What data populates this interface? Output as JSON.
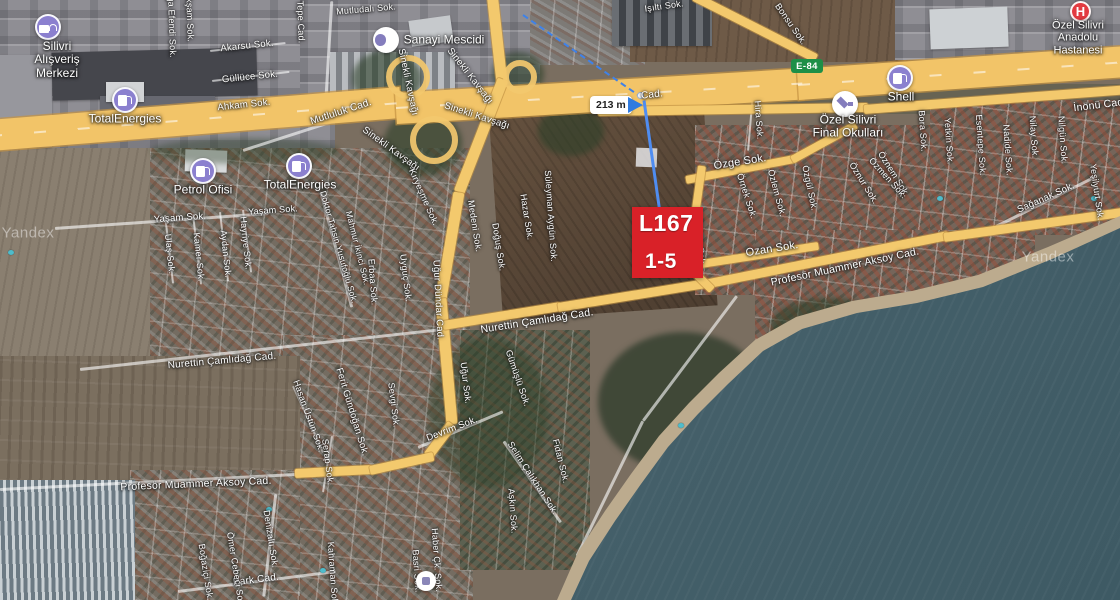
{
  "map": {
    "provider_watermark": "Yandex",
    "road_badge": "E-84",
    "measurement": {
      "distance_label": "213 m"
    },
    "parcel_label": {
      "line1": "L167",
      "line2": "1-5"
    },
    "colors": {
      "parcel_red": "#d92128",
      "measure_blue": "#3f82e8",
      "road_yellow": "#f3c96d",
      "poi_purple": "#8b80cf",
      "badge_green": "#1d8f47",
      "sea_teal": "#44606a"
    }
  },
  "watermarks": [
    {
      "text": "Yandex",
      "x": 28,
      "y": 233
    },
    {
      "text": "Yandex",
      "x": 1048,
      "y": 257
    }
  ],
  "pois": [
    {
      "id": "silivri-alisveris-merkezi",
      "icon": "bag",
      "x": 48,
      "y": 27,
      "lines": [
        "Silivri",
        "Alışveriş",
        "Merkezi"
      ],
      "lx": 57,
      "ly": 60
    },
    {
      "id": "totalenergies-north",
      "icon": "fuel",
      "x": 125,
      "y": 100,
      "lines": [
        "TotalEnergies"
      ],
      "lx": 125,
      "ly": 119
    },
    {
      "id": "totalenergies-south",
      "icon": "fuel",
      "x": 299,
      "y": 166,
      "lines": [
        "TotalEnergies"
      ],
      "lx": 300,
      "ly": 185
    },
    {
      "id": "petrol-ofisi",
      "icon": "fuel",
      "x": 203,
      "y": 171,
      "lines": [
        "Petrol Ofisi"
      ],
      "lx": 203,
      "ly": 190
    },
    {
      "id": "sanayi-mescidi",
      "icon": "mosque",
      "x": 386,
      "y": 40,
      "lines": [
        "Sanayi Mescidi"
      ],
      "lx": 444,
      "ly": 40
    },
    {
      "id": "shell",
      "icon": "fuel",
      "x": 900,
      "y": 78,
      "lines": [
        "Shell"
      ],
      "lx": 901,
      "ly": 97
    },
    {
      "id": "ozel-silivri-final-okullari",
      "icon": "school",
      "x": 845,
      "y": 104,
      "lines": [
        "Özel Silivri",
        "Final Okulları"
      ],
      "lx": 848,
      "ly": 127
    },
    {
      "id": "ozel-silivri-anadolu-hastanesi",
      "icon": "hospital",
      "x": 1080,
      "y": 11,
      "lines": [
        "Özel Silivri",
        "Anadolu",
        "Hastanesi"
      ],
      "lx": 1078,
      "ly": 38,
      "ls": 11
    },
    {
      "id": "poi-unlabeled",
      "icon": "generic",
      "x": 426,
      "y": 581,
      "lines": [],
      "lx": 426,
      "ly": 595
    }
  ],
  "street_labels": [
    {
      "t": "Akarsu Sok.",
      "x": 247,
      "y": 46,
      "r": -6
    },
    {
      "t": "Güllüce Sok.",
      "x": 250,
      "y": 77,
      "r": -6
    },
    {
      "t": "Ahkam Sok.",
      "x": 244,
      "y": 105,
      "r": -6
    },
    {
      "t": "Ağa Efendi Sok.",
      "x": 172,
      "y": 24,
      "r": 88,
      "s": 9
    },
    {
      "t": "Akşam Sok.",
      "x": 190,
      "y": 17,
      "r": 88,
      "s": 9
    },
    {
      "t": "Tepe Cad.",
      "x": 301,
      "y": 22,
      "r": 88,
      "s": 9
    },
    {
      "t": "Mutludalı Sok.",
      "x": 366,
      "y": 9,
      "r": -5,
      "s": 9
    },
    {
      "t": "Mutluluk Cad.",
      "x": 341,
      "y": 112,
      "r": -18,
      "s": 10
    },
    {
      "t": "Sinekli Kavşağı",
      "x": 408,
      "y": 82,
      "r": 78
    },
    {
      "t": "Sinekli Kavşağı",
      "x": 470,
      "y": 76,
      "r": 52
    },
    {
      "t": "Sinekli Kavşağı",
      "x": 477,
      "y": 116,
      "r": 18
    },
    {
      "t": "Sinekli Kavşağı",
      "x": 391,
      "y": 149,
      "r": 36
    },
    {
      "t": "Kıryeşme Sok.",
      "x": 424,
      "y": 197,
      "r": 66,
      "s": 9
    },
    {
      "t": "Süleyman Aygün Sok.",
      "x": 551,
      "y": 216,
      "r": 86,
      "s": 9
    },
    {
      "t": "Işıltı Sok.",
      "x": 664,
      "y": 6,
      "r": -8,
      "s": 9
    },
    {
      "t": "Bonsu Sok.",
      "x": 791,
      "y": 24,
      "r": 55,
      "s": 9
    },
    {
      "t": "Cad.",
      "x": 652,
      "y": 95,
      "r": -6,
      "s": 10
    },
    {
      "t": "Özge Sok.",
      "x": 740,
      "y": 162,
      "r": -9,
      "s": 11
    },
    {
      "t": "Hira Sok.",
      "x": 759,
      "y": 120,
      "r": 86,
      "s": 9
    },
    {
      "t": "Örnek Sok.",
      "x": 747,
      "y": 196,
      "r": 72,
      "s": 9
    },
    {
      "t": "Özlem Sok.",
      "x": 777,
      "y": 193,
      "r": 75,
      "s": 9
    },
    {
      "t": "Özgül Sok.",
      "x": 810,
      "y": 188,
      "r": 78,
      "s": 9
    },
    {
      "t": "Öznur Sok.",
      "x": 864,
      "y": 183,
      "r": 58,
      "s": 9
    },
    {
      "t": "Öznem Sok.",
      "x": 894,
      "y": 174,
      "r": 58,
      "s": 9
    },
    {
      "t": "Özmen Sok.",
      "x": 888,
      "y": 178,
      "r": 48,
      "s": 9
    },
    {
      "t": "Özcan Sok.",
      "x": 700,
      "y": 242,
      "r": 84,
      "s": 9
    },
    {
      "t": "Ozan Sok.",
      "x": 772,
      "y": 249,
      "r": -9,
      "s": 11
    },
    {
      "t": "Profesör Muammer Aksoy Cad.",
      "x": 845,
      "y": 267,
      "r": -12,
      "s": 10.5
    },
    {
      "t": "Profesör Muammer Aksoy Cad.",
      "x": 196,
      "y": 484,
      "r": -2.5,
      "s": 10.5
    },
    {
      "t": "Nurettin Çamlıdağ Cad.",
      "x": 537,
      "y": 321,
      "r": -9,
      "s": 10.5
    },
    {
      "t": "Nurettin Çamlıdağ Cad.",
      "x": 222,
      "y": 361,
      "r": -5,
      "s": 10
    },
    {
      "t": "Yaşam Sok.",
      "x": 180,
      "y": 218,
      "r": -4
    },
    {
      "t": "Yaşam Sok.",
      "x": 273,
      "y": 210,
      "r": -4,
      "s": 9
    },
    {
      "t": "Ulaş Sok.",
      "x": 170,
      "y": 254,
      "r": 84,
      "s": 9
    },
    {
      "t": "Kamer Sok.",
      "x": 199,
      "y": 257,
      "r": 84,
      "s": 9
    },
    {
      "t": "Aydan Sok.",
      "x": 226,
      "y": 254,
      "r": 84,
      "s": 9
    },
    {
      "t": "Hayriye Sok.",
      "x": 246,
      "y": 243,
      "r": 84,
      "s": 9
    },
    {
      "t": "Doktor Tahsin Yusufoğlu Sok.",
      "x": 339,
      "y": 247,
      "r": 74,
      "s": 8.5
    },
    {
      "t": "Mahmur İkinci Sok.",
      "x": 358,
      "y": 248,
      "r": 76,
      "s": 8.5
    },
    {
      "t": "Erbaa Sok.",
      "x": 373,
      "y": 282,
      "r": 86,
      "s": 9
    },
    {
      "t": "Uyguç Sok.",
      "x": 406,
      "y": 278,
      "r": 83,
      "s": 9
    },
    {
      "t": "Uğur Dündar Cad.",
      "x": 438,
      "y": 300,
      "r": 87,
      "s": 9.5
    },
    {
      "t": "Medeni Sok.",
      "x": 475,
      "y": 226,
      "r": 81,
      "s": 9
    },
    {
      "t": "Doğuş Sok.",
      "x": 499,
      "y": 247,
      "r": 81,
      "s": 9
    },
    {
      "t": "Hazar Sok.",
      "x": 527,
      "y": 217,
      "r": 81,
      "s": 9
    },
    {
      "t": "Hasan Üstün Sok.",
      "x": 309,
      "y": 416,
      "r": 70,
      "s": 9
    },
    {
      "t": "Ferit Gündoğan Sok.",
      "x": 352,
      "y": 412,
      "r": 73,
      "s": 9.5
    },
    {
      "t": "Serap Sok.",
      "x": 328,
      "y": 462,
      "r": 83,
      "s": 9
    },
    {
      "t": "Sevgi Sok.",
      "x": 394,
      "y": 405,
      "r": 83,
      "s": 9
    },
    {
      "t": "Uğur Sok.",
      "x": 466,
      "y": 383,
      "r": 83,
      "s": 9
    },
    {
      "t": "Devrim Sok.",
      "x": 452,
      "y": 429,
      "r": -21,
      "s": 9.5
    },
    {
      "t": "Gümüşlü Sok.",
      "x": 518,
      "y": 378,
      "r": 71,
      "s": 9
    },
    {
      "t": "Selim Çalıkhan Sok.",
      "x": 533,
      "y": 478,
      "r": 57,
      "s": 9
    },
    {
      "t": "Aşkın Sok.",
      "x": 513,
      "y": 511,
      "r": 86,
      "s": 9
    },
    {
      "t": "Fidan Sok.",
      "x": 561,
      "y": 461,
      "r": 76,
      "s": 9
    },
    {
      "t": "Haber Çk. Sok.",
      "x": 437,
      "y": 560,
      "r": 86,
      "s": 9
    },
    {
      "t": "Basri Sok.",
      "x": 417,
      "y": 571,
      "r": 86,
      "s": 9
    },
    {
      "t": "Kahraman Sok.",
      "x": 333,
      "y": 574,
      "r": 86,
      "s": 9
    },
    {
      "t": "Park Cad.",
      "x": 256,
      "y": 580,
      "r": -7,
      "s": 10
    },
    {
      "t": "Denizaltı Sok.",
      "x": 271,
      "y": 539,
      "r": 81,
      "s": 9
    },
    {
      "t": "Boğaziçi Sok.",
      "x": 206,
      "y": 572,
      "r": 81,
      "s": 9
    },
    {
      "t": "Ömer Cebeci Sok.",
      "x": 236,
      "y": 570,
      "r": 81,
      "s": 9
    },
    {
      "t": "İnönü Cad.",
      "x": 1100,
      "y": 105,
      "r": -7,
      "s": 10.5
    },
    {
      "t": "Bora Sok.",
      "x": 923,
      "y": 131,
      "r": 86,
      "s": 9
    },
    {
      "t": "Yetkin Sok.",
      "x": 949,
      "y": 141,
      "r": 86,
      "s": 9
    },
    {
      "t": "Esentepe Sok.",
      "x": 981,
      "y": 145,
      "r": 86,
      "s": 9
    },
    {
      "t": "Nadide Sok.",
      "x": 1008,
      "y": 150,
      "r": 86,
      "s": 9
    },
    {
      "t": "Nilay Sok.",
      "x": 1034,
      "y": 137,
      "r": 86,
      "s": 9
    },
    {
      "t": "Nilgün Sok.",
      "x": 1063,
      "y": 140,
      "r": 86,
      "s": 9
    },
    {
      "t": "Sağanak Sok.",
      "x": 1046,
      "y": 198,
      "r": -24,
      "s": 9.5
    },
    {
      "t": "Yeşilyurt Sok.",
      "x": 1097,
      "y": 192,
      "r": 82,
      "s": 9
    }
  ]
}
